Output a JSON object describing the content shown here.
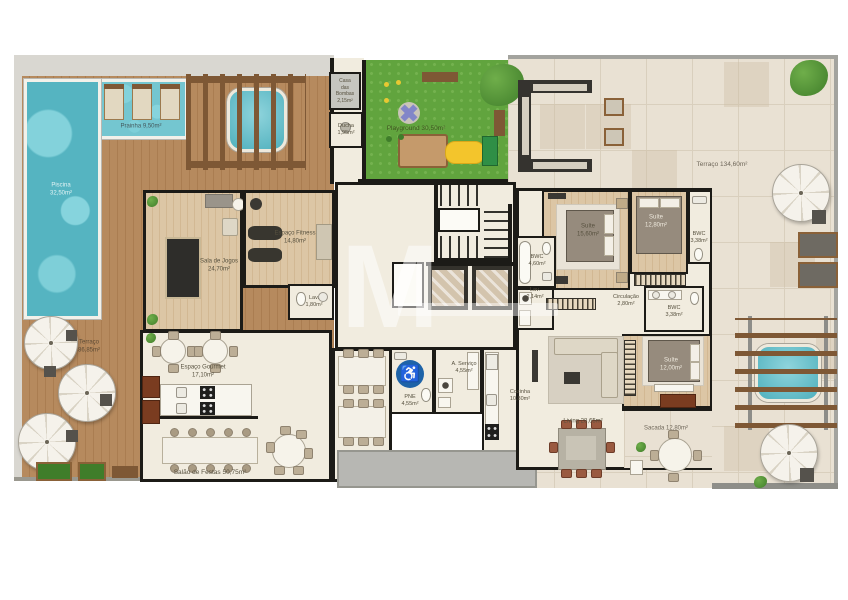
{
  "plan": {
    "type": "residential-floor-plan"
  },
  "labels": {
    "prainha": "Prainha 9,50m²",
    "piscina": "Piscina\n32,50m²",
    "casa_bombas": "Casa\ndas\nBombas\n2,15m²",
    "ducha": "Ducha\n1,95m²",
    "playground": "Playground 30,50m²",
    "terraco_top": "Terraço 134,60m²",
    "terraco_left": "Terraço\n86,85m²",
    "sala_jogos": "Sala de Jogos\n24,70m²",
    "fitness": "Espaço Fitness\n14,80m²",
    "lav_comum": "Lav.\n1,80m²",
    "suite1": "Suíte\n15,60m²",
    "suite2": "Suíte\n12,80m²",
    "bwc_suite2": "BWC\n3,38m²",
    "bwc_suite1": "BWC\n4,60m²",
    "lav_apto": "Lav.\n2,14m²",
    "circulacao": "Circulação\n2,80m²",
    "bwc_suite3": "BWC\n3,38m²",
    "suite3": "Suíte\n12,00m²",
    "living": "Living 28,65m²",
    "sacada": "Sacada 12,80m²",
    "gourmet": "Espaço Gourmet\n17,10m²",
    "salao": "Salão de Festas 50,75m²",
    "pne": "PNE\n4,55m²",
    "servico": "A. Serviço\n4,55m²",
    "cozinha": "Cozinha\n10,80m²"
  },
  "icons": {
    "wheelchair": "♿"
  },
  "watermark": {
    "letter": "M"
  },
  "colors": {
    "pool": "#55B4C1",
    "deck_wood": "#B5895D",
    "grass": "#61A43E",
    "stone": "#E9E1D3",
    "wall": "#1C1B17",
    "pne_blue": "#1E63A8",
    "interior": "#F1ECDF"
  }
}
